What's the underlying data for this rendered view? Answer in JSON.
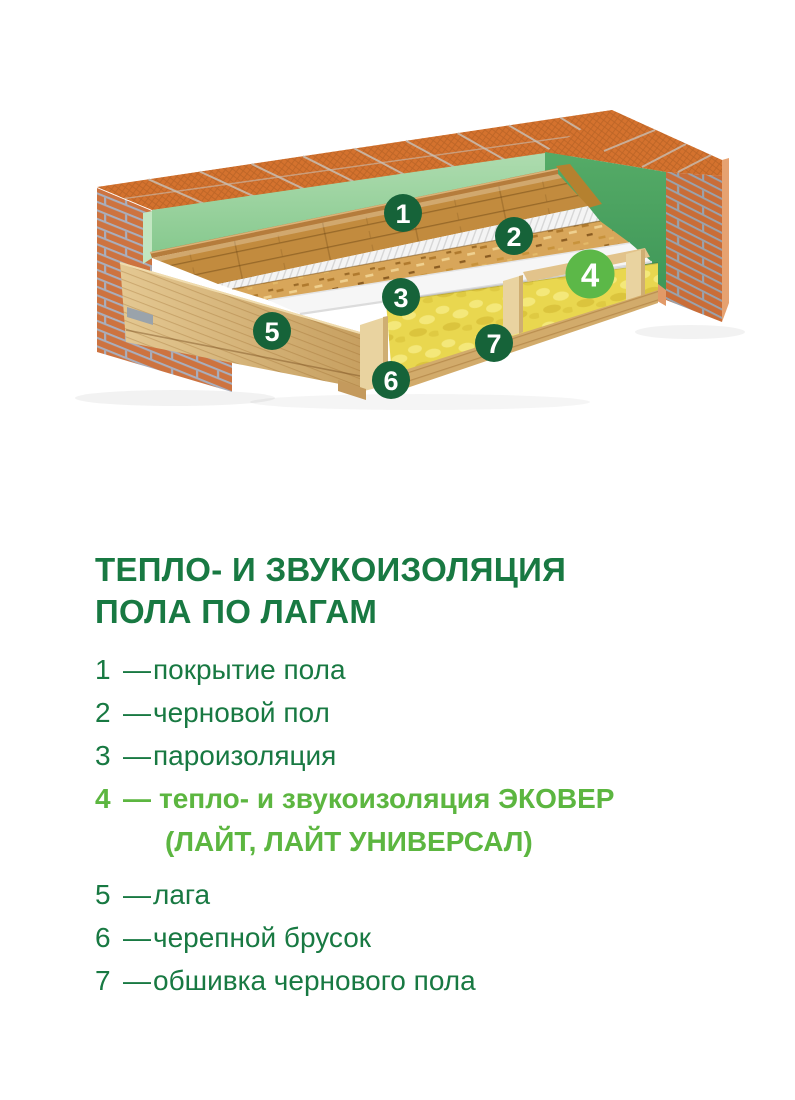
{
  "title": {
    "line1": "ТЕПЛО- И ЗВУКОИЗОЛЯЦИЯ",
    "line2": "ПОЛА ПО ЛАГАМ"
  },
  "legend": {
    "dash": "—",
    "text_color": "#187942",
    "highlight_color": "#5cb640",
    "items": [
      {
        "number": "1",
        "label": "покрытие пола"
      },
      {
        "number": "2",
        "label": "черновой пол"
      },
      {
        "number": "3",
        "label": "пароизоляция"
      },
      {
        "number": "4",
        "label": "тепло- и звукоизоляция ЭКОВЕР",
        "label_line2": "(ЛАЙТ, ЛАЙТ УНИВЕРСАЛ)",
        "highlighted": true
      },
      {
        "number": "5",
        "label": "лага"
      },
      {
        "number": "6",
        "label": "черепной брусок"
      },
      {
        "number": "7",
        "label": "обшивка чернового пола"
      }
    ]
  },
  "illustration": {
    "palette": {
      "marker_green": "#166339",
      "marker_highlight_green": "#5cb848",
      "brick_orange": "#cd7340",
      "brick_top_orange": "#d4722e",
      "mortar_grey": "#a9aebc",
      "wall_panel_green_light": "#a3d8a4",
      "wall_panel_green_dark": "#4da25e",
      "parquet_wood": "#c28b3e",
      "osb_tan": "#d8a65a",
      "vapor_barrier_white": "#f6f6f6",
      "insulation_yellow": "#e9d74f",
      "joist_wood": "#dcbc82"
    }
  }
}
